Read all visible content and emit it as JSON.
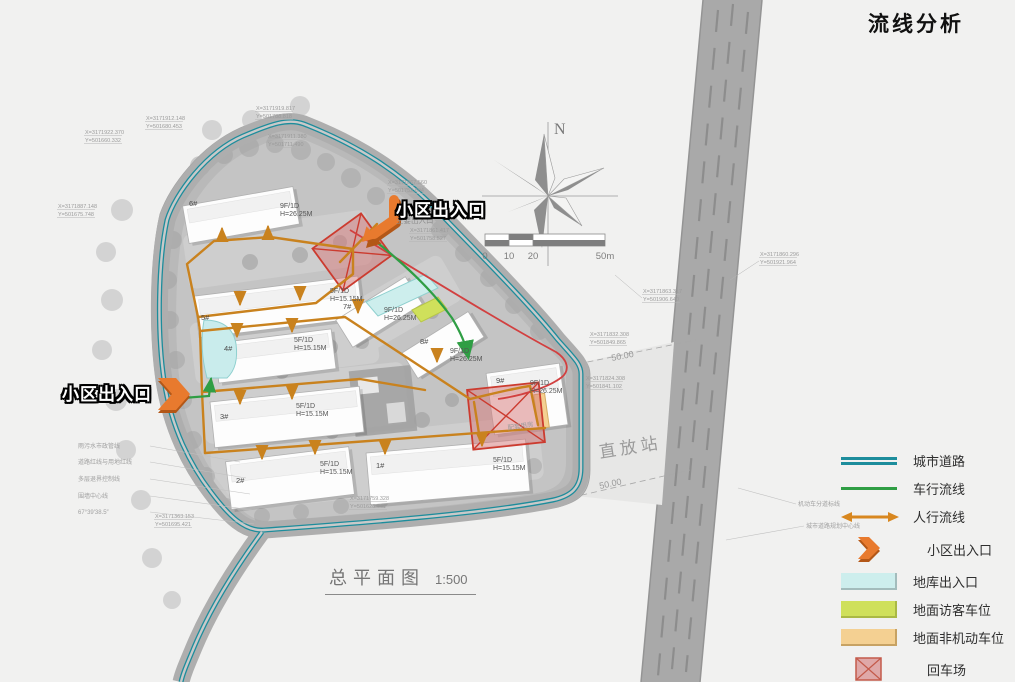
{
  "title": "流线分析",
  "plan_caption": {
    "name": "总平面图",
    "scale": "1:500"
  },
  "compass": {
    "north_label": "N"
  },
  "scale_bar": {
    "labels": [
      "0",
      "10",
      "20",
      "50m"
    ]
  },
  "legend": {
    "items": [
      {
        "key": "city-road",
        "label": "城市道路"
      },
      {
        "key": "vehicle-flow",
        "label": "车行流线"
      },
      {
        "key": "pedestrian-flow",
        "label": "人行流线"
      },
      {
        "key": "community-entrance",
        "label": "小区出入口"
      },
      {
        "key": "garage-entrance",
        "label": "地库出入口"
      },
      {
        "key": "visitor-parking",
        "label": "地面访客车位"
      },
      {
        "key": "non-motorized-parking",
        "label": "地面非机动车位"
      },
      {
        "key": "turnaround",
        "label": "回车场"
      }
    ]
  },
  "callouts": {
    "top": "小区出入口",
    "left": "小区出入口"
  },
  "site": {
    "repeater_station": "直放站",
    "dim_upper": "50.00",
    "dim_lower": "50.00",
    "support_room": "配套用房",
    "main_entrance_note": "主要出入口"
  },
  "buildings": [
    {
      "id": "1#",
      "floors": "5F/1D",
      "height": "H=15.15M"
    },
    {
      "id": "2#",
      "floors": "5F/1D",
      "height": "H=15.15M"
    },
    {
      "id": "3#",
      "floors": "5F/1D",
      "height": "H=15.15M"
    },
    {
      "id": "4#",
      "floors": "5F/1D",
      "height": "H=15.15M"
    },
    {
      "id": "5#",
      "floors": "5F/1D",
      "height": "H=15.15M"
    },
    {
      "id": "6#",
      "floors": "9F/1D",
      "height": "H=26.25M"
    },
    {
      "id": "7#",
      "floors": "9F/1D",
      "height": "H=26.25M"
    },
    {
      "id": "8#",
      "floors": "9F/1D",
      "height": "H=26.25M"
    },
    {
      "id": "9#",
      "floors": "9F/1D",
      "height": "H=26.25M"
    }
  ],
  "coordinates": [
    {
      "x": "X=3171922.370",
      "y": "Y=501660.332"
    },
    {
      "x": "X=3171912.148",
      "y": "Y=501680.453"
    },
    {
      "x": "X=3171919.817",
      "y": "Y=501788.818"
    },
    {
      "x": "X=3171911.380",
      "y": "Y=501711.490"
    },
    {
      "x": "X=3171887.148",
      "y": "Y=501675.748"
    },
    {
      "x": "X=3171867.560",
      "y": "Y=501752.894"
    },
    {
      "x": "X=3171861.417",
      "y": "Y=501758.527"
    },
    {
      "x": "X=3171863.317",
      "y": "Y=501906.640"
    },
    {
      "x": "X=3171860.296",
      "y": "Y=501921.964"
    },
    {
      "x": "X=3171832.308",
      "y": "Y=501849.865"
    },
    {
      "x": "X=3171824.308",
      "y": "Y=501841.102"
    },
    {
      "x": "X=3171363.153",
      "y": "Y=501695.421"
    },
    {
      "x": "X=3171759.328",
      "y": "Y=501628.741"
    }
  ],
  "annotations": {
    "left": [
      "雨污水市政管线",
      "道路红线与用地红线",
      "多层退界控制线",
      "围墙中心线",
      "67°39′38.5″"
    ],
    "road": [
      "机动车分道标线",
      "城市道路规划中心线"
    ]
  },
  "colors": {
    "road_teal": "#1d8d9c",
    "flow_green": "#2f9e44",
    "flow_orange": "#c9821e",
    "entrance_orange": "#e87a2e",
    "garage_cyan": "#cdeeed",
    "visitor_green": "#cfe05b",
    "nonmotor_tan": "#f4d092",
    "turnaround_red": "#cc3b2f"
  }
}
